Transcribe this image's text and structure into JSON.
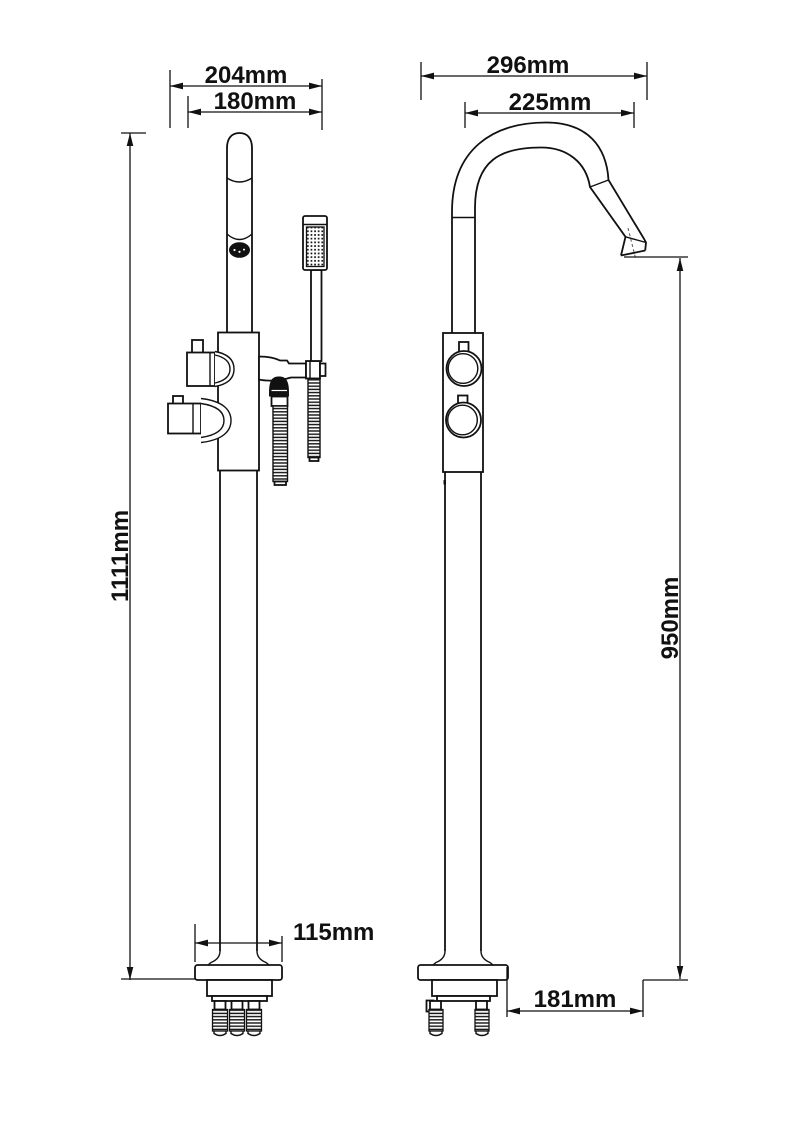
{
  "drawing": {
    "title": "Freestanding bath shower mixer tap - dimension drawing",
    "views": {
      "left": "front view",
      "right": "side view"
    },
    "colors": {
      "line": "#111111",
      "background": "#ffffff",
      "hose_fill": "#111111"
    }
  },
  "dimensions": {
    "front": {
      "overall_width": "204mm",
      "inner_width": "180mm",
      "total_height": "1111mm",
      "base_width": "115mm"
    },
    "side": {
      "overall_depth": "296mm",
      "spout_reach": "225mm",
      "spout_height": "950mm",
      "base_to_spout": "181mm"
    }
  }
}
